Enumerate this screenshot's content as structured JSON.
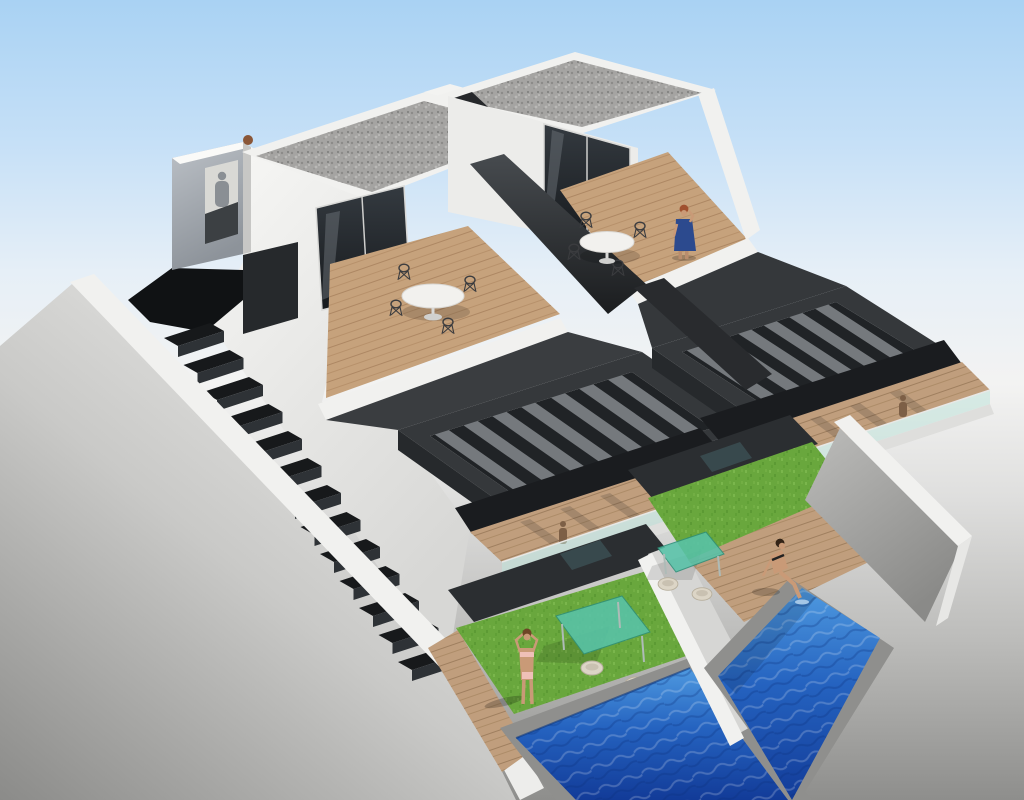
{
  "meta": {
    "title": "3D architectural rendering - modern semi-detached villas with private pools",
    "type": "architectural_3d_render",
    "width": 1024,
    "height": 800
  },
  "scene": {
    "subject": "Aerial three-quarter view of two attached modern white villas",
    "style": "contemporary new-build visualisation on studio sky backdrop",
    "units": 2,
    "levels": [
      "gravel flat roof",
      "roof terrace with round dining table",
      "anthracite louvre pergola over first-floor terrace",
      "ground-floor garden with lawn and private pool"
    ],
    "features": [
      "white rendered walls",
      "anthracite pergola louvres",
      "glass balustrades",
      "external side staircase",
      "white perimeter walls",
      "artificial grass lawns",
      "wood decking",
      "two rectangular swimming pools"
    ],
    "people": [
      {
        "id": "woman-on-phone",
        "location": "right roof terrace",
        "appearance": "blue dress, red hair"
      },
      {
        "id": "woman-standing",
        "location": "left garden lawn",
        "appearance": "bikini, arms raised"
      },
      {
        "id": "woman-sitting",
        "location": "right pool edge",
        "appearance": "bikini, feet in water"
      },
      {
        "id": "shadow-silhouette",
        "location": "stair tower landing",
        "appearance": "cast shadow of a person"
      },
      {
        "id": "small-figure-left",
        "location": "left first-floor terrace"
      },
      {
        "id": "small-figure-right",
        "location": "right first-floor terrace"
      }
    ],
    "furniture": {
      "roof_tables": 2,
      "roof_chairs_per_table": 4,
      "garden_glass_tables": 2,
      "garden_chairs": 4
    },
    "counts": {
      "stair_steps": 13,
      "pergola_slats_left": 7,
      "pergola_slats_right": 6,
      "pools": 2,
      "gravel_roofs": 2
    }
  },
  "colors": {
    "sky_top": "#a9d2f3",
    "ground": "#8e8e8c",
    "wall_white": "#f1f1ef",
    "wall_grey": "#b5b5b3",
    "anthracite": "#35383b",
    "anthracite_dark": "#202326",
    "slat_grey": "#75797d",
    "stair_dark": "#17191b",
    "stair_riser": "#2e3236",
    "gravel": "#a5a4a2",
    "wood": "#c6a27c",
    "wood_dark": "#aa8460",
    "glass": "#24282c",
    "glass_balustrade": "#bfe3db",
    "grass": "#69a73d",
    "pool_light": "#4f9ae0",
    "pool_dark": "#123b98",
    "coping": "#8f8f8d",
    "teal_glass": "#58c3a9",
    "skin": "#c99a77",
    "dress_blue": "#2c4a8e",
    "hair_red": "#a0512f",
    "finial_brown": "#8a5637"
  }
}
